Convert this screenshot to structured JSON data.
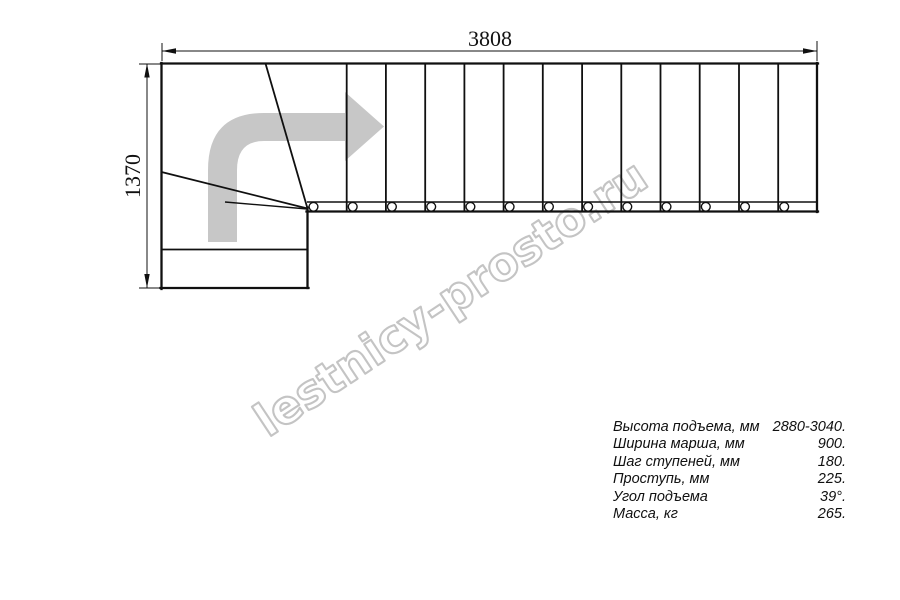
{
  "drawing": {
    "watermark": {
      "text": "lestnicy-prosto.ru"
    },
    "dimensions": {
      "width_mm": "3808",
      "height_mm": "1370"
    },
    "stair": {
      "straight_treads": 13,
      "winder_treads": 2,
      "lower_treads": 2,
      "balusters": 13,
      "turn": "90-degree left-to-right turn, direction arrow up then right"
    },
    "colors": {
      "line": "#101010",
      "arrow_gray": "#c7c7c7",
      "watermark_gray": "#c4c4c4"
    }
  },
  "specs": {
    "rows": [
      {
        "label": "Высота подъема, мм",
        "value": "2880-3040."
      },
      {
        "label": "Ширина марша, мм",
        "value": "900."
      },
      {
        "label": "Шаг ступеней, мм",
        "value": "180."
      },
      {
        "label": "Проступь, мм",
        "value": "225."
      },
      {
        "label": "Угол подъема",
        "value": "39°."
      },
      {
        "label": "Масса, кг",
        "value": "265."
      }
    ]
  }
}
